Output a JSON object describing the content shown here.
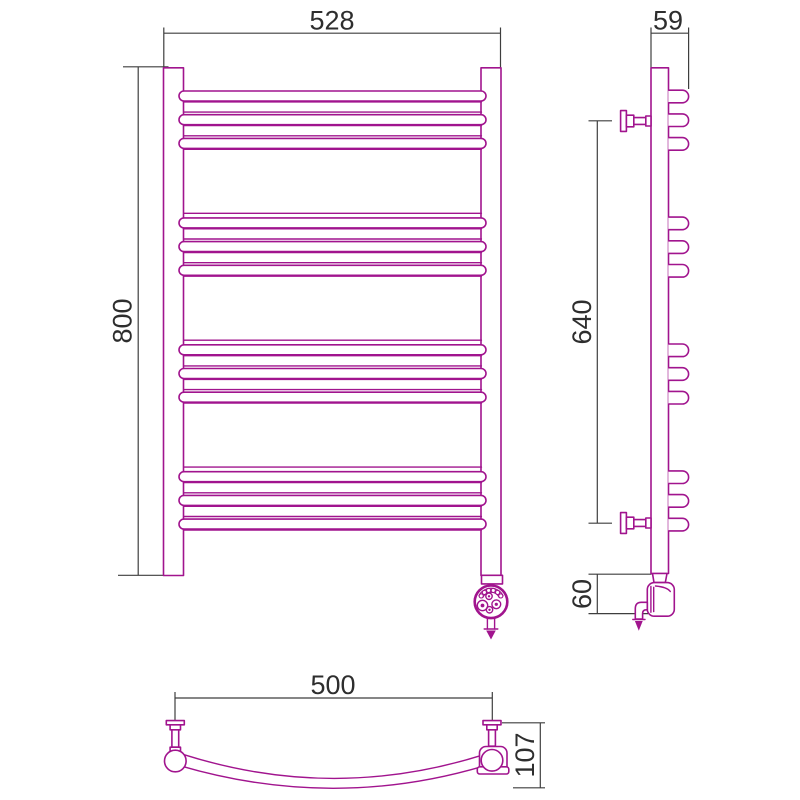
{
  "drawing": {
    "kind": "technical-drawing",
    "subject": "curved-ladder-towel-rail-three-views",
    "colors": {
      "outline": "#A1148E",
      "dimension_lines": "#3E3E3E",
      "dimension_text": "#2E2E2E",
      "background": "#FFFFFF"
    },
    "front_view": {
      "rung_groups": 4,
      "rungs_per_group": 3,
      "dims": {
        "width": "528",
        "height": "800"
      }
    },
    "side_view": {
      "rung_groups": 4,
      "rungs_per_group": 3,
      "dims": {
        "depth": "59",
        "bracket_span": "640",
        "element_drop": "60"
      }
    },
    "plan_view": {
      "dims": {
        "rail_width": "500",
        "curve_depth": "107"
      }
    }
  }
}
